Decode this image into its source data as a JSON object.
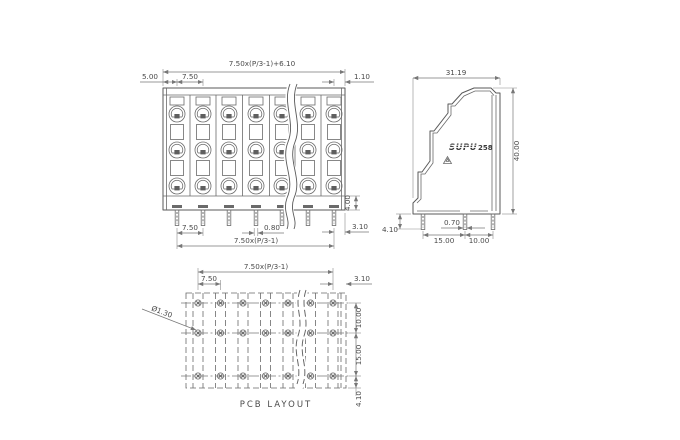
{
  "colors": {
    "line": "#5a5a5a",
    "dimension": "#777777",
    "text": "#4a4a4a",
    "background": "#ffffff"
  },
  "front_view": {
    "dims": {
      "top_formula": "7.50x(P/3-1)+6.10",
      "left_offset": "5.00",
      "pitch": "7.50",
      "right_offset": "1.10",
      "slot_height": "4.00",
      "pin_right_offset": "3.10",
      "pin_pitch": "7.50",
      "pin_width": "0.80",
      "pin_span_formula": "7.50x(P/3-1)"
    }
  },
  "side_view": {
    "brand": "SUPU",
    "model": "258",
    "dims": {
      "width": "31.19",
      "height": "40.00",
      "pin_width": "0.70",
      "pin_length": "4.10",
      "pin_spacing_front": "15.00",
      "pin_spacing_rear": "10.00"
    }
  },
  "pcb_layout": {
    "title": "PCB LAYOUT",
    "dims": {
      "span_formula": "7.50x(P/3-1)",
      "pitch": "7.50",
      "right_offset": "3.10",
      "row_gap_top": "10.00",
      "row_gap_bottom": "15.00",
      "bottom_offset": "4.10",
      "hole_diameter": "Ø1.30"
    }
  }
}
